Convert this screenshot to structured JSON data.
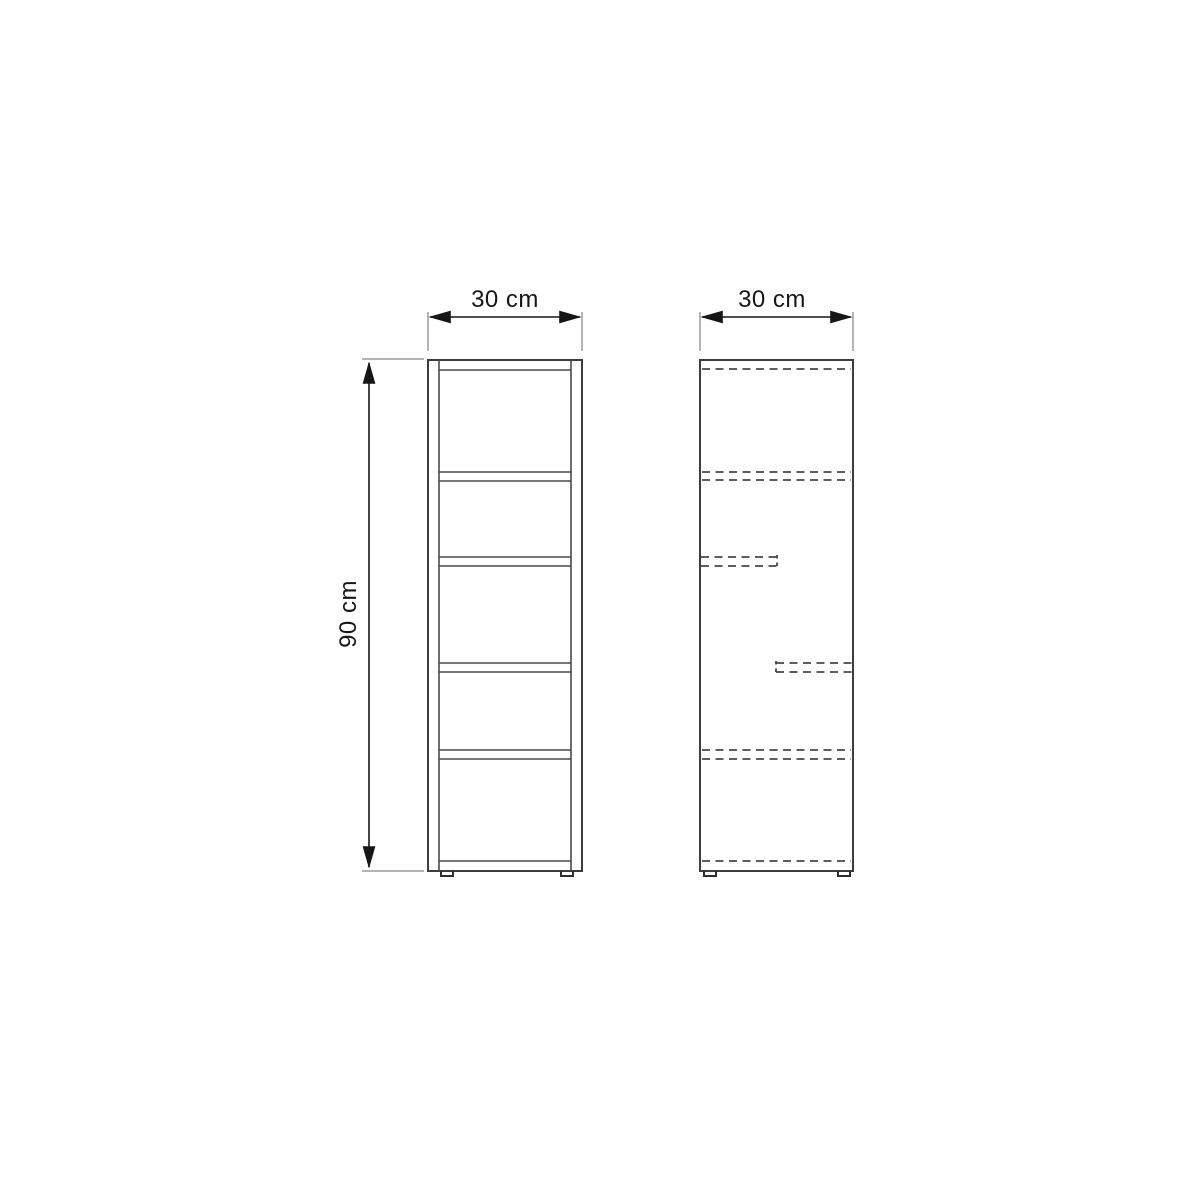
{
  "diagram": {
    "kind": "furniture dimension drawing (shelf unit, two orthographic views)",
    "front_view": {
      "width_label": "30 cm",
      "height_label": "90 cm",
      "compartments": 5,
      "shelf_count": 4
    },
    "side_view": {
      "depth_label": "30 cm",
      "hidden_shelf_lines": 4
    },
    "colors": {
      "background": "#ffffff",
      "outline": "#3d3d3d",
      "hidden_edge_dashed": "#474747",
      "dimension": "#161616",
      "extension": "#9c9c9c"
    }
  }
}
